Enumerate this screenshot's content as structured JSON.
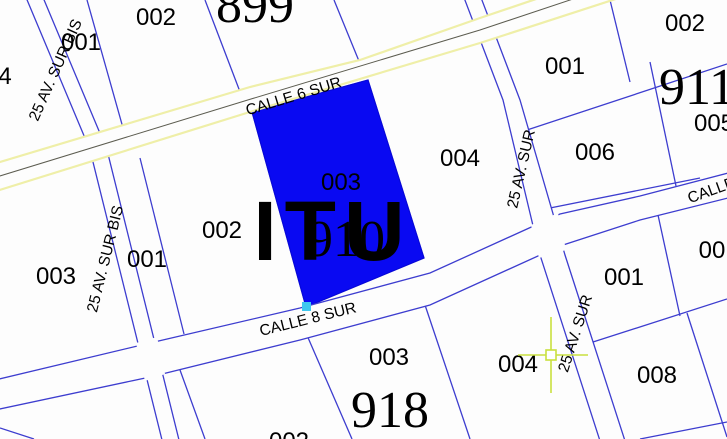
{
  "colors": {
    "background": "#fdfdfd",
    "parcel_line": "#3d3dcf",
    "highlight_parcel": "#0909f2",
    "highlight_edge": "#0606d8",
    "road_casing_yellow": "#efefa8",
    "road_center_dark": "#5c5c50",
    "handle_cyan": "#3fc8ef",
    "crosshair_green": "#c9e03f",
    "label_black": "#000000",
    "watermark": "rgba(228,228,242,0.6)"
  },
  "watermark": {
    "text": "ITU"
  },
  "streets": {
    "calle6": {
      "label": "CALLE 6 SUR"
    },
    "calle8": {
      "label": "CALLE 8 SUR"
    },
    "calle_right": {
      "label": "CALLE"
    },
    "av25bis": {
      "label": "25 AV. SUR BIS"
    },
    "av25": {
      "label": "25 AV. SUR"
    }
  },
  "blocks": {
    "b899": "899",
    "b910": "910",
    "b911": "911",
    "b918": "918",
    "left_partial": "4"
  },
  "parcels": {
    "tl_001": "001",
    "tl_002": "002",
    "left_003": "003",
    "b910_001": "001",
    "b910_002": "002",
    "b910_003": "003",
    "b910_004": "004",
    "b911_001": "001",
    "b911_002": "002",
    "b911_005": "005",
    "b911_006": "006",
    "right_001": "001",
    "right_00x": "00",
    "right_008": "008",
    "b918_002": "002",
    "b918_003": "003",
    "b918_004": "004"
  },
  "selection": {
    "selected_parcel_label": "003",
    "selected_block_label": "910"
  }
}
